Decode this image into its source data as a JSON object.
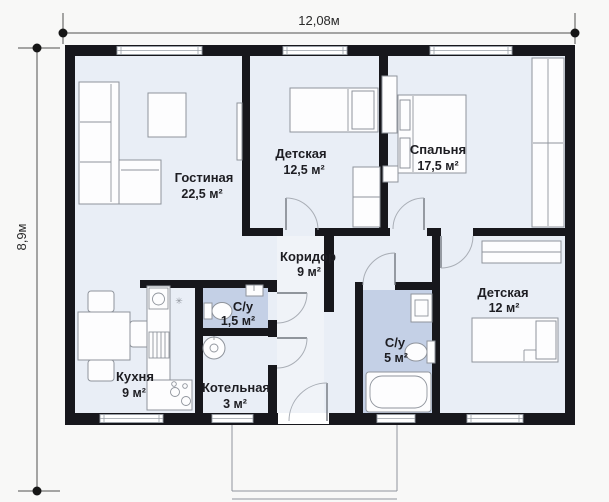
{
  "plan": {
    "dim_width": "12,08м",
    "dim_height": "8,9м",
    "rooms": [
      {
        "name": "Гостиная",
        "area": "22,5 м²"
      },
      {
        "name": "Детская",
        "area": "12,5 м²"
      },
      {
        "name": "Спальня",
        "area": "17,5 м²"
      },
      {
        "name": "Коридор",
        "area": "9 м²"
      },
      {
        "name": "С/у",
        "area": "1,5 м²"
      },
      {
        "name": "Кухня",
        "area": "9 м²"
      },
      {
        "name": "Котельная",
        "area": "3 м²"
      },
      {
        "name": "С/у",
        "area": "5 м²"
      },
      {
        "name": "Детская",
        "area": "12 м²"
      }
    ],
    "colors": {
      "wall": "#17171c",
      "floor": "#e9eef6",
      "wet_floor": "#c4d0e6",
      "background": "#f8f8f7",
      "furniture_line": "#8f949c",
      "text": "#1d1d22"
    }
  }
}
